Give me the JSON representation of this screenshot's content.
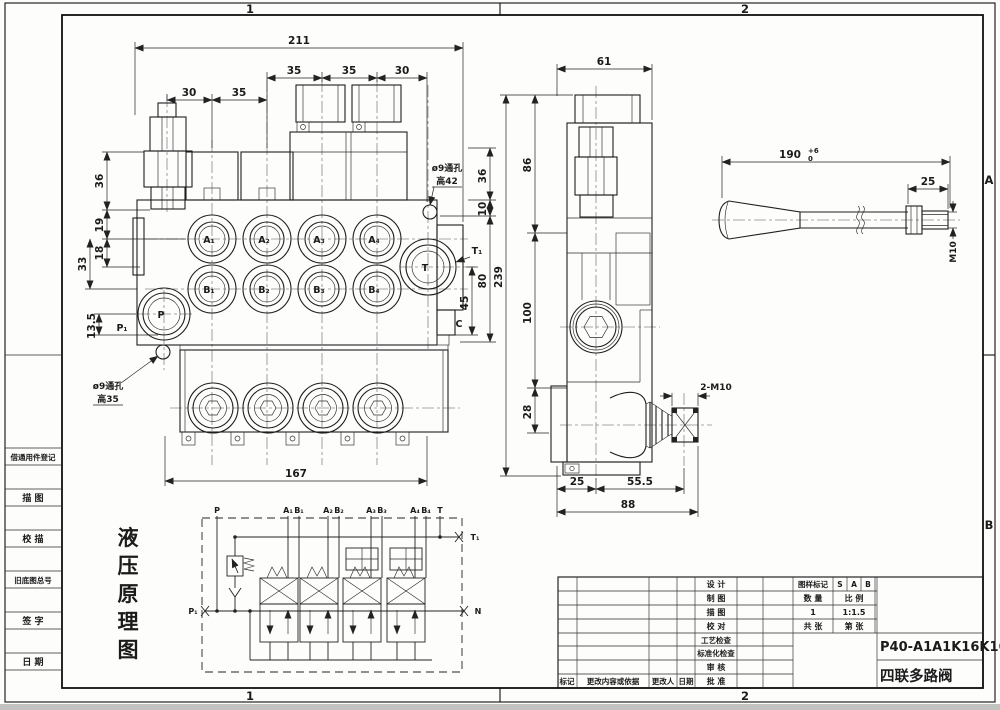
{
  "frame": {
    "zone_col_1": "1",
    "zone_col_2": "2",
    "zone_row_a": "A",
    "zone_row_b": "B"
  },
  "left_panel": {
    "rows": [
      "借通用件登记",
      "描  图",
      "校  描",
      "旧底图总号",
      "签  字",
      "日  期"
    ]
  },
  "drawing_title": {
    "chars": [
      "液",
      "压",
      "原",
      "理",
      "图"
    ]
  },
  "front_view": {
    "dims": {
      "w211": "211",
      "t35a": "35",
      "t35b": "35",
      "t30": "30",
      "l30": "30",
      "l35": "35",
      "h36": "36",
      "h19": "19",
      "h18": "18",
      "h33": "33",
      "h135": "13.5",
      "r36": "36",
      "r10": "10",
      "r80": "80",
      "r45": "45",
      "b167": "167"
    },
    "ports": {
      "a1": "A₁",
      "a2": "A₂",
      "a3": "A₃",
      "a4": "A₄",
      "b1": "B₁",
      "b2": "B₂",
      "b3": "B₃",
      "b4": "B₄",
      "p": "P",
      "t": "T",
      "p1": "P₁",
      "t1": "T₁",
      "c": "C"
    },
    "notes": {
      "hole_top_1": "ø9通孔",
      "hole_top_2": "高42",
      "hole_bot_1": "ø9通孔",
      "hole_bot_2": "高35"
    }
  },
  "side_view": {
    "dims": {
      "w61": "61",
      "h86": "86",
      "h239": "239",
      "h100": "100",
      "h28": "28",
      "b25": "25",
      "b555": "55.5",
      "b88": "88"
    },
    "note_thread": "2-M10"
  },
  "lever_view": {
    "dims": {
      "len": "190",
      "tol_hi": "+6",
      "tol_lo": "0",
      "d25": "25",
      "m10": "M10"
    }
  },
  "schematic": {
    "ports": {
      "p": "P",
      "t": "T",
      "t1": "T₁",
      "p1": "P₁",
      "n": "N",
      "a1": "A₁",
      "b1": "B₁",
      "a2": "A₂",
      "b2": "B₂",
      "a3": "A₃",
      "b3": "B₃",
      "a4": "A₄",
      "b4": "B₄"
    }
  },
  "title_block": {
    "roles": [
      "设  计",
      "制  图",
      "描  图",
      "校  对",
      "工艺检查",
      "标准化检查",
      "审  核",
      "批  准"
    ],
    "rev_headers": [
      "标记",
      "更改内容或依据",
      "更改人",
      "日期"
    ],
    "mark_label": "图样标记",
    "marks": [
      "S",
      "A",
      "B"
    ],
    "qty_label": "数  量",
    "scale_label": "比  例",
    "qty": "1",
    "scale": "1:1.5",
    "total_label": "共  张",
    "page_label": "第  张",
    "part_no": "P40-A1A1K16K16",
    "part_name": "四联多路阀"
  }
}
